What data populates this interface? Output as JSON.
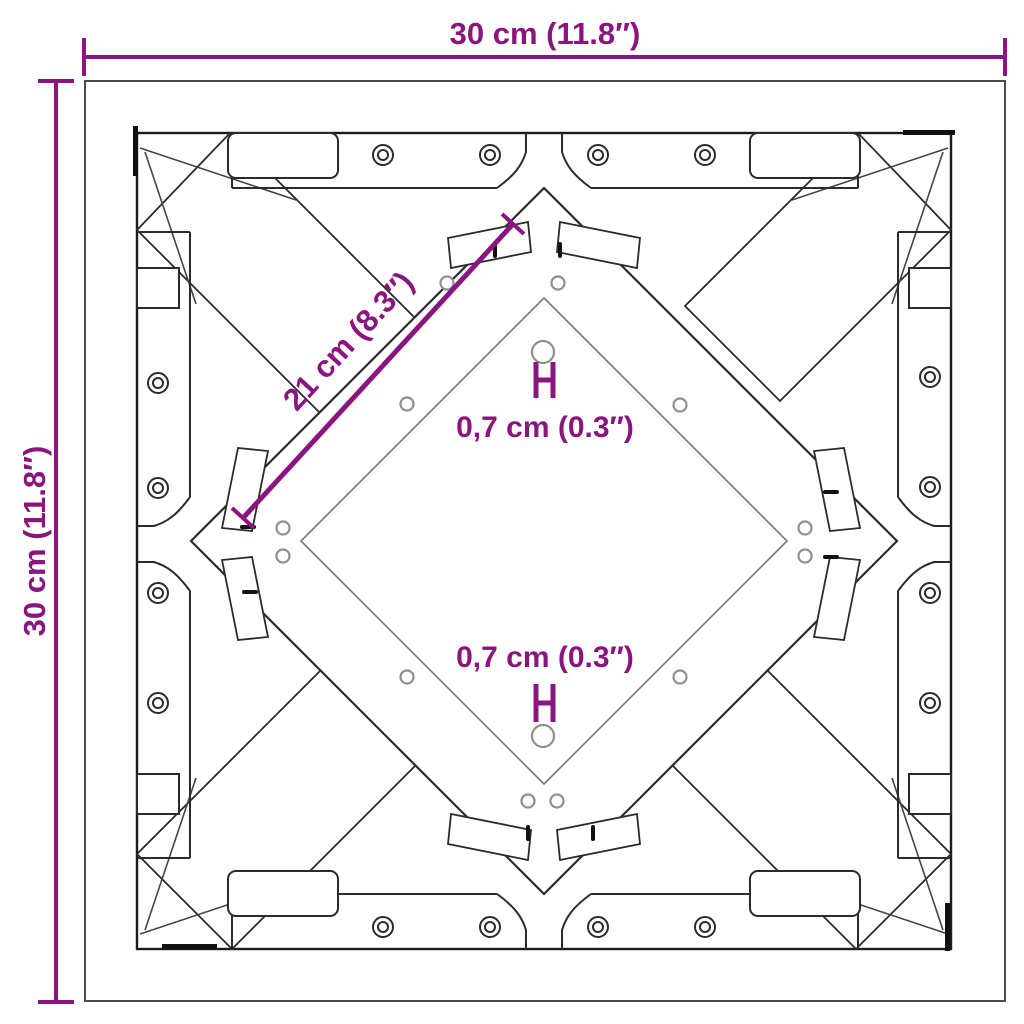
{
  "colors": {
    "accent": "#8a157e",
    "line": "#2b2b2b"
  },
  "labels": {
    "dim_width": "30 cm (11.8″)",
    "dim_height": "30 cm (11.8″)",
    "dim_brace": "21 cm (8.3″)",
    "dim_hole_top": "0,7 cm (0.3″)",
    "dim_hole_bottom": "0,7 cm (0.3″)"
  }
}
